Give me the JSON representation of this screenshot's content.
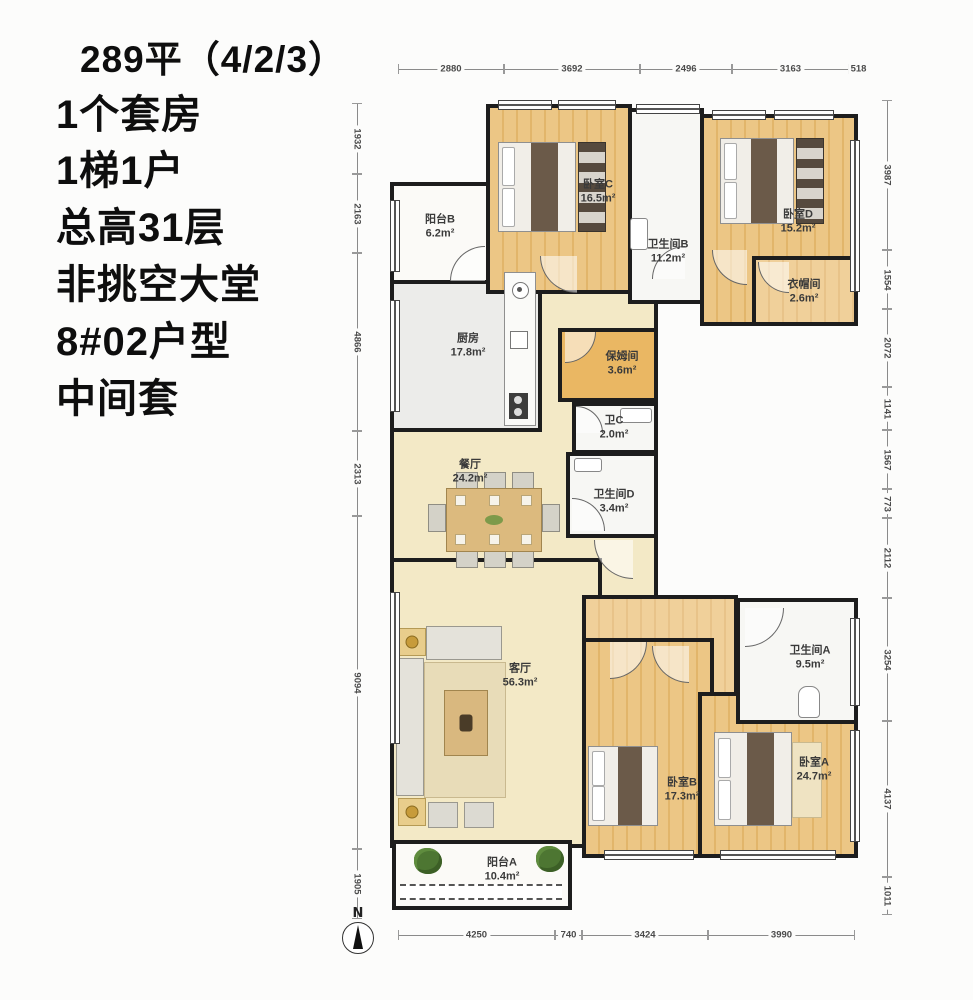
{
  "info": {
    "lines": [
      "289平（4/2/3）",
      "1个套房",
      "1梯1户",
      "总高31层",
      "非挑空大堂",
      "8#02户型",
      "中间套"
    ]
  },
  "rooms": {
    "balcony_b": {
      "name": "阳台B",
      "area": "6.2m²"
    },
    "bedroom_c": {
      "name": "卧室C",
      "area": "16.5m²"
    },
    "bath_b": {
      "name": "卫生间B",
      "area": "11.2m²"
    },
    "bedroom_d": {
      "name": "卧室D",
      "area": "15.2m²"
    },
    "cloakroom": {
      "name": "衣帽间",
      "area": "2.6m²"
    },
    "kitchen": {
      "name": "厨房",
      "area": "17.8m²"
    },
    "nanny": {
      "name": "保姆间",
      "area": "3.6m²"
    },
    "bath_c": {
      "name": "卫C",
      "area": "2.0m²"
    },
    "dining": {
      "name": "餐厅",
      "area": "24.2m²"
    },
    "bath_d": {
      "name": "卫生间D",
      "area": "3.4m²"
    },
    "living": {
      "name": "客厅",
      "area": "56.3m²"
    },
    "bath_a": {
      "name": "卫生间A",
      "area": "9.5m²"
    },
    "bedroom_b": {
      "name": "卧室B",
      "area": "17.3m²"
    },
    "bedroom_a": {
      "name": "卧室A",
      "area": "24.7m²"
    },
    "balcony_a": {
      "name": "阳台A",
      "area": "10.4m²"
    }
  },
  "dimensions": {
    "top": [
      "2880",
      "3692",
      "2496",
      "3163",
      "518"
    ],
    "bottom": [
      "4250",
      "740",
      "3424",
      "3990"
    ],
    "left": [
      "1932",
      "2163",
      "4866",
      "2313",
      "9094",
      "1905"
    ],
    "right": [
      "3987",
      "1554",
      "2072",
      "1141",
      "1567",
      "773",
      "2112",
      "3254",
      "4137",
      "1011"
    ]
  },
  "compass": {
    "label": "N"
  },
  "colors": {
    "wall": "#1d1d1d",
    "wood_floor": "#ecc685",
    "cream_floor": "#f3e9c6",
    "accent_orange": "#eab763"
  }
}
